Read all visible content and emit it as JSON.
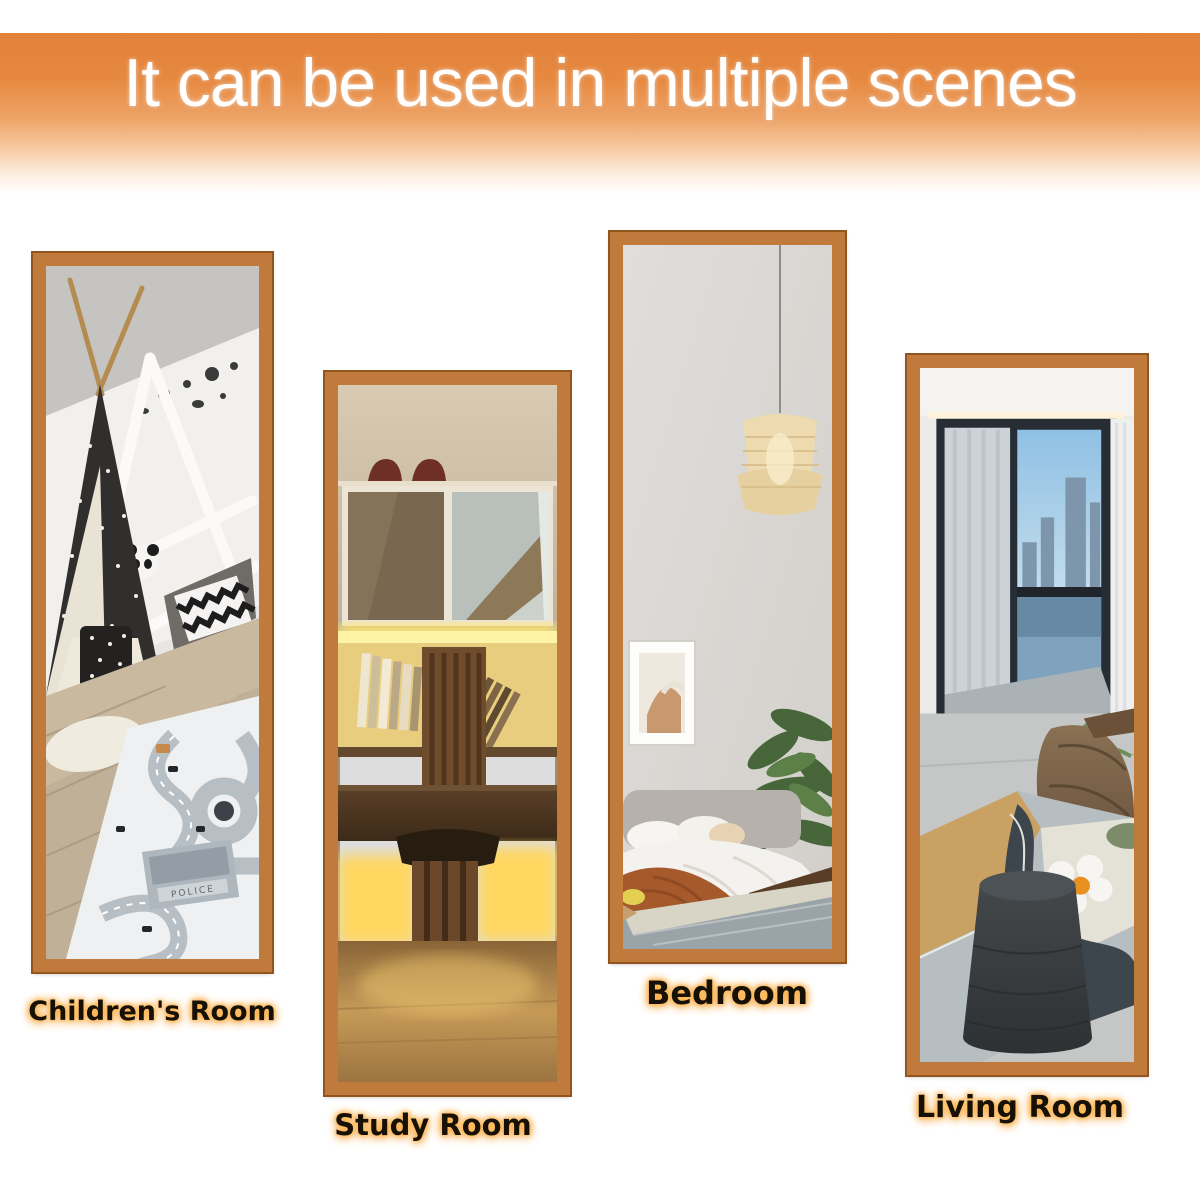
{
  "header": {
    "title": "It can be used in multiple scenes",
    "band_color": "#e5873c",
    "text_color": "#ffffff"
  },
  "mirrors": [
    {
      "id": "children-room",
      "label": "Children's Room",
      "scene": "kids room reflected in tall framed mirror: black-and-white teepee tent, white house-frame toddler bed with panda and chevron cushions, road play mat on wood floor",
      "frame_color": "#bf7a3c"
    },
    {
      "id": "study-room",
      "label": "Study Room",
      "scene": "study reflected in tall framed mirror: wall cabinets with shoes on top, warm yellow LED strip lighting, books, dark wood desk and slatted stool on wood floor",
      "frame_color": "#bf7a3c"
    },
    {
      "id": "bedroom",
      "label": "Bedroom",
      "scene": "bedroom reflected in tall framed mirror: rattan pendant lamp, framed art, green plant, bed with white duvet and rust throw, grey geometric rug",
      "frame_color": "#bf7a3c"
    },
    {
      "id": "living-room",
      "label": "Living Room",
      "scene": "living room reflected in tall framed mirror: black-framed balcony window with city view, sheer curtains, bean bag, abstract rug with daisy cushion, charcoal pouf",
      "frame_color": "#bf7a3c"
    }
  ],
  "scenes": {
    "children": {
      "mat_building_label": "POLICE"
    }
  }
}
